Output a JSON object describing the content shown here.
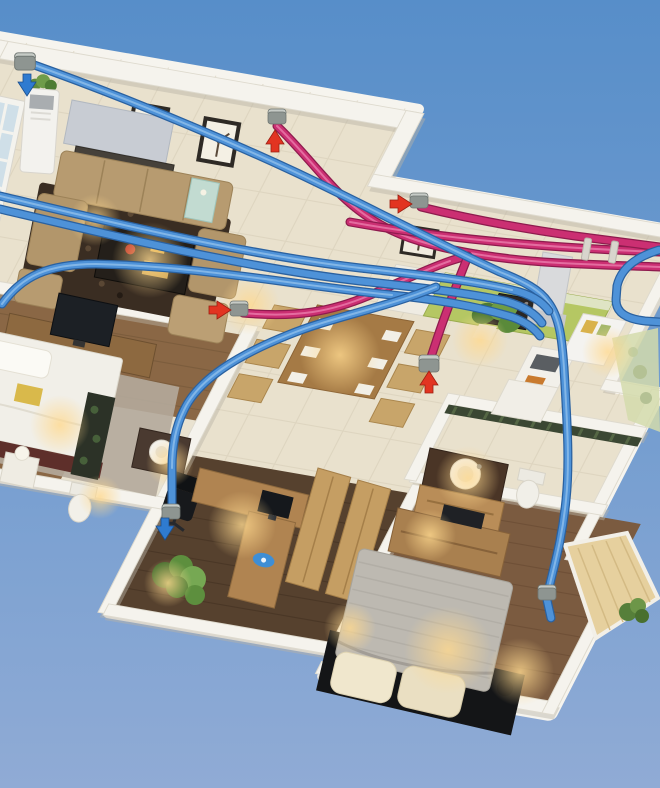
{
  "scene": {
    "title": "3D cutaway floor plan of an apartment with a ducted fresh-air ventilation system",
    "style": "isometric 3D architectural render on a sky-blue background, no text labels",
    "colors": {
      "sky_top": "#578ec9",
      "sky_bottom": "#90abd5",
      "walls": "#f5f3ed",
      "tile_floor": "#e9e1cd",
      "supply_duct": "#4e92d8",
      "supply_duct_dark": "#2a61a0",
      "exhaust_duct": "#cb2f72",
      "exhaust_duct_dark": "#8e1b4e",
      "red_arrow": "#e23421",
      "blue_arrow": "#2f7bd0",
      "vent_cap": "#8e9591"
    },
    "duct_system": {
      "supply": {
        "color_name": "blue",
        "role": "fresh air supply",
        "routes": [
          "enters through exterior wall cap at top-left of living room",
          "bundle of parallel runs sweeps diagonally across living room and dining area",
          "elbow down past kitchen, descending through second bathroom to master bedroom wall vent",
          "S-curve branch through hallway down the study wall to a floor-level vent",
          "exterior elbows at right edge of kitchen wing"
        ]
      },
      "exhaust": {
        "color_name": "pink / magenta",
        "role": "stale air exhaust",
        "routes": [
          "riser from living room rear-wall vent curving to rear parapet",
          "two parallel runs along rear parapet exiting at right edge, held by straps",
          "drop to floor vent between dining area and kitchen",
          "run from hallway vent near TV wall crossing under the blue bundle"
        ]
      }
    },
    "vents": [
      {
        "id": "outdoor-intake",
        "location": "exterior wall, top-left of living room",
        "arrow": "down",
        "arrow_color": "blue"
      },
      {
        "id": "living-room-exhaust",
        "location": "living room rear wall",
        "arrow": "up",
        "arrow_color": "red"
      },
      {
        "id": "dining-rear-wall-exhaust",
        "location": "rear wall above dining area",
        "arrow": "right",
        "arrow_color": "red"
      },
      {
        "id": "hallway-exhaust",
        "location": "hallway near TV wall",
        "arrow": "right",
        "arrow_color": "red"
      },
      {
        "id": "kitchen-floor-exhaust",
        "location": "floor between dining area and kitchen",
        "arrow": "up",
        "arrow_color": "red"
      },
      {
        "id": "study-supply",
        "location": "study wall at floor level",
        "arrow": "down",
        "arrow_color": "blue"
      },
      {
        "id": "master-bedroom-supply",
        "location": "master bedroom side wall",
        "arrow": "none",
        "arrow_color": null
      }
    ],
    "rooms": [
      {
        "name": "living room",
        "floor": "beige tile",
        "furniture": [
          "tan sectional sofa",
          "dark shag rug",
          "dark coffee table with red decanter",
          "bar counter with gray canopy",
          "floor-standing AC unit with plant",
          "french window",
          "two framed tree pictures",
          "teal glass side table",
          "TV on wood sideboard"
        ]
      },
      {
        "name": "dining area",
        "floor": "beige tile",
        "furniture": [
          "wooden dining table with six chairs and place settings",
          "potted plant",
          "white cabinet"
        ]
      },
      {
        "name": "kitchen",
        "floor": "beige tile",
        "furniture": [
          "green cabinet run",
          "built-in oven",
          "range hood",
          "sink counter with cutting board",
          "refrigerator"
        ]
      },
      {
        "name": "bedroom",
        "floor": "medium wood",
        "furniture": [
          "white double bed with pillows and yellow throw",
          "gray area rug",
          "nightstand with lamp",
          "dark shelf unit"
        ]
      },
      {
        "name": "bathroom",
        "floor": "tile",
        "furniture": [
          "round basin on dark vanity",
          "toilet"
        ]
      },
      {
        "name": "study",
        "floor": "dark wood",
        "furniture": [
          "L-shaped wooden desk",
          "monitor",
          "black office chair",
          "blue mouse pad",
          "potted plant"
        ]
      },
      {
        "name": "second bathroom",
        "floor": "tile",
        "furniture": [
          "vessel sink on dark counter with wood cabinet",
          "toilet",
          "dark mosaic accent wall"
        ]
      },
      {
        "name": "master bedroom",
        "floor": "medium wood",
        "furniture": [
          "large bed with gray striped duvet",
          "two cream pillows",
          "dark platform base",
          "wood dresser",
          "tall wardrobe door panels"
        ]
      },
      {
        "name": "balcony",
        "floor": "light wood deck",
        "furniture": [
          "potted plant"
        ]
      }
    ]
  }
}
